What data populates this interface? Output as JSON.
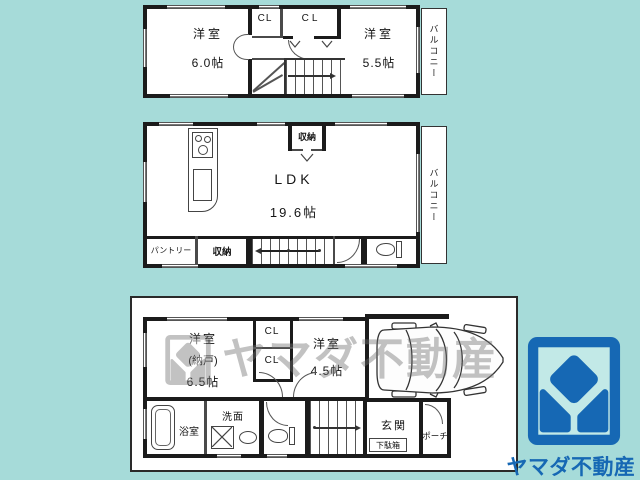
{
  "colors": {
    "background": "#a6dbd9",
    "wall": "#1b1b1b",
    "logo_blue": "#1668b4",
    "logo_inner_teal": "#c2e9e7",
    "watermark_gray": "#6f6f6f"
  },
  "floor3": {
    "room_left": {
      "name": "洋室",
      "size": "6.0帖"
    },
    "room_right": {
      "name": "洋室",
      "size": "5.5帖"
    },
    "closet1": "CL",
    "closet2": "CL",
    "balcony": "バルコニー"
  },
  "floor2": {
    "ldk_name": "LDK",
    "ldk_size": "19.6帖",
    "storage_top": "収納",
    "pantry": "パントリー",
    "storage_bottom": "収納",
    "balcony": "バルコニー"
  },
  "floor1": {
    "room_left": {
      "name": "洋室",
      "sub": "(納戸)",
      "size": "6.5帖"
    },
    "room_right": {
      "name": "洋室",
      "size": "4.5帖"
    },
    "closet1": "CL",
    "closet2": "CL",
    "bath": "浴室",
    "washroom": "洗面",
    "entrance": "玄関",
    "shoe_box": "下駄箱",
    "porch": "ポーチ"
  },
  "watermark": {
    "text": "ヤマダ不動産"
  },
  "brand": {
    "name": "ヤマダ不動産"
  }
}
